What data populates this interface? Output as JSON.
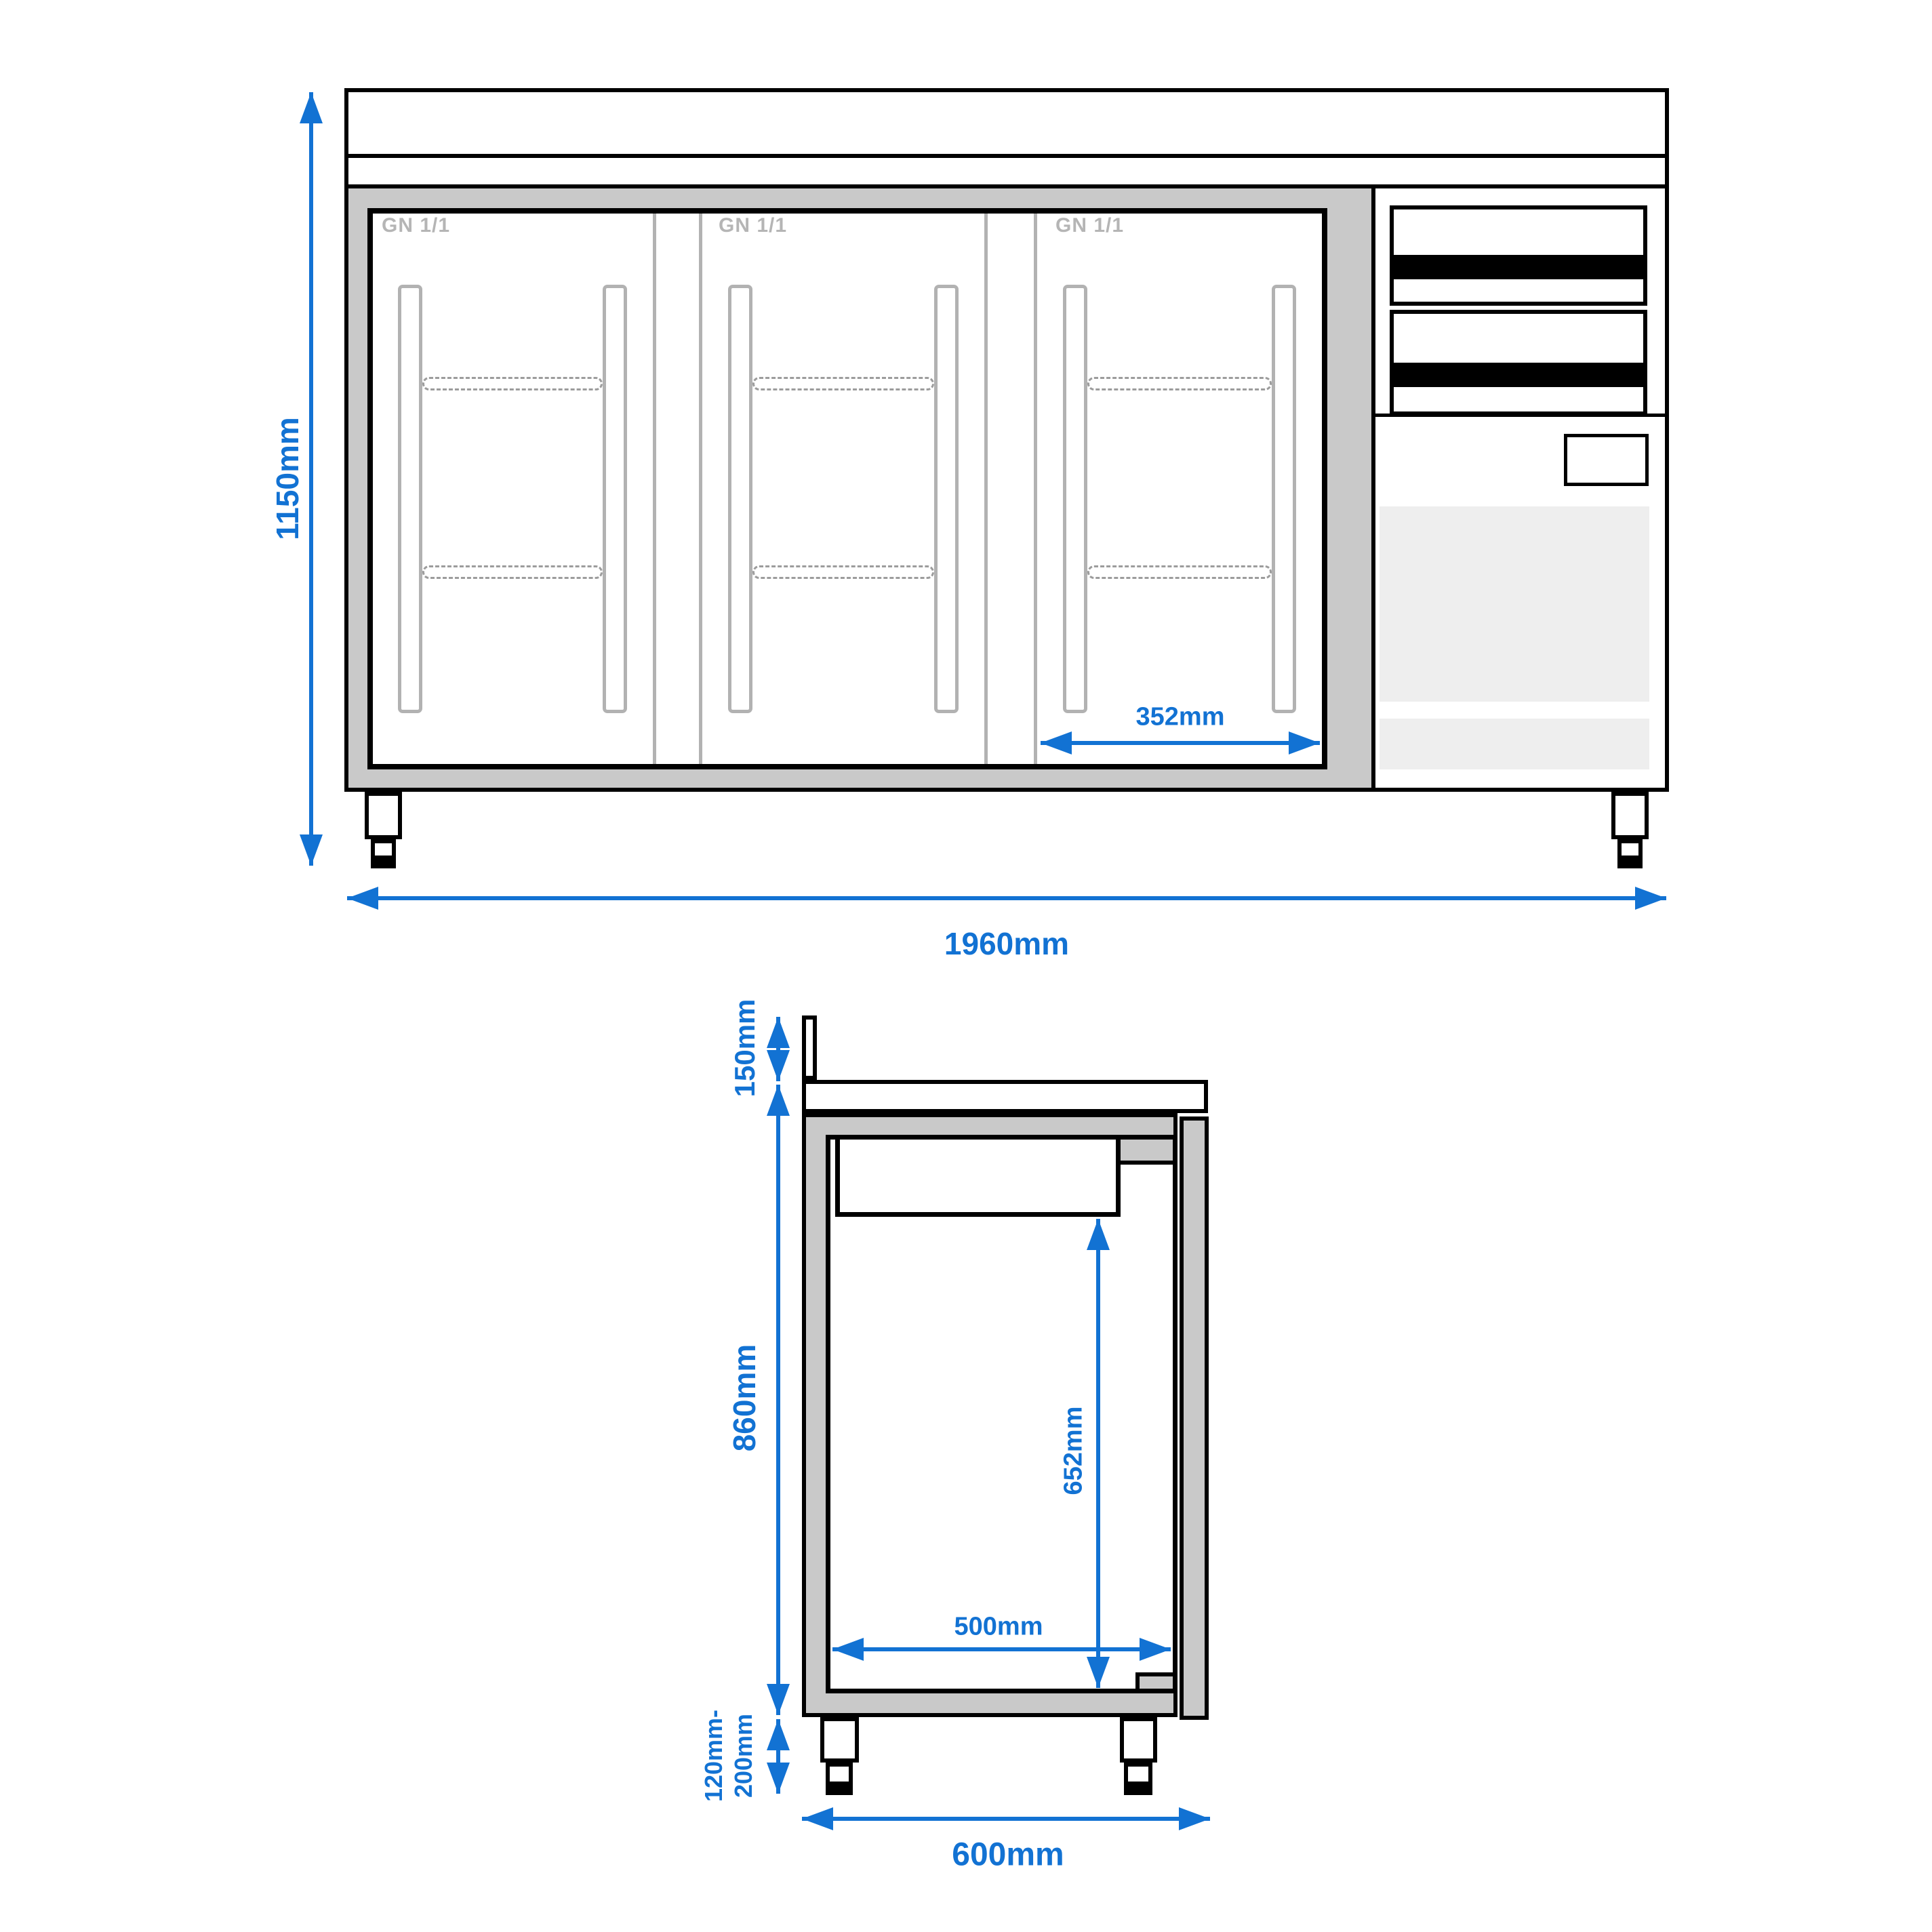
{
  "front_view": {
    "doors": [
      {
        "label": "GN 1/1"
      },
      {
        "label": "GN 1/1"
      },
      {
        "label": "GN 1/1"
      }
    ],
    "dimensions": {
      "overall_height": "1150mm",
      "overall_width": "1960mm",
      "door_opening_width": "352mm"
    }
  },
  "side_view": {
    "dimensions": {
      "upstand_height": "150mm",
      "body_height": "860mm",
      "inner_height": "652mm",
      "inner_depth": "500mm",
      "feet_height_line1": "120mm-",
      "feet_height_line2": "200mm",
      "overall_depth": "600mm"
    }
  },
  "colors": {
    "blue": "#1272d3",
    "frame": "#c9c9c9",
    "strip": "#b2b2b2",
    "gn": "#b5b5b5",
    "dash": "#9c9c9c",
    "light": "#eeeeee",
    "black": "#000000"
  }
}
